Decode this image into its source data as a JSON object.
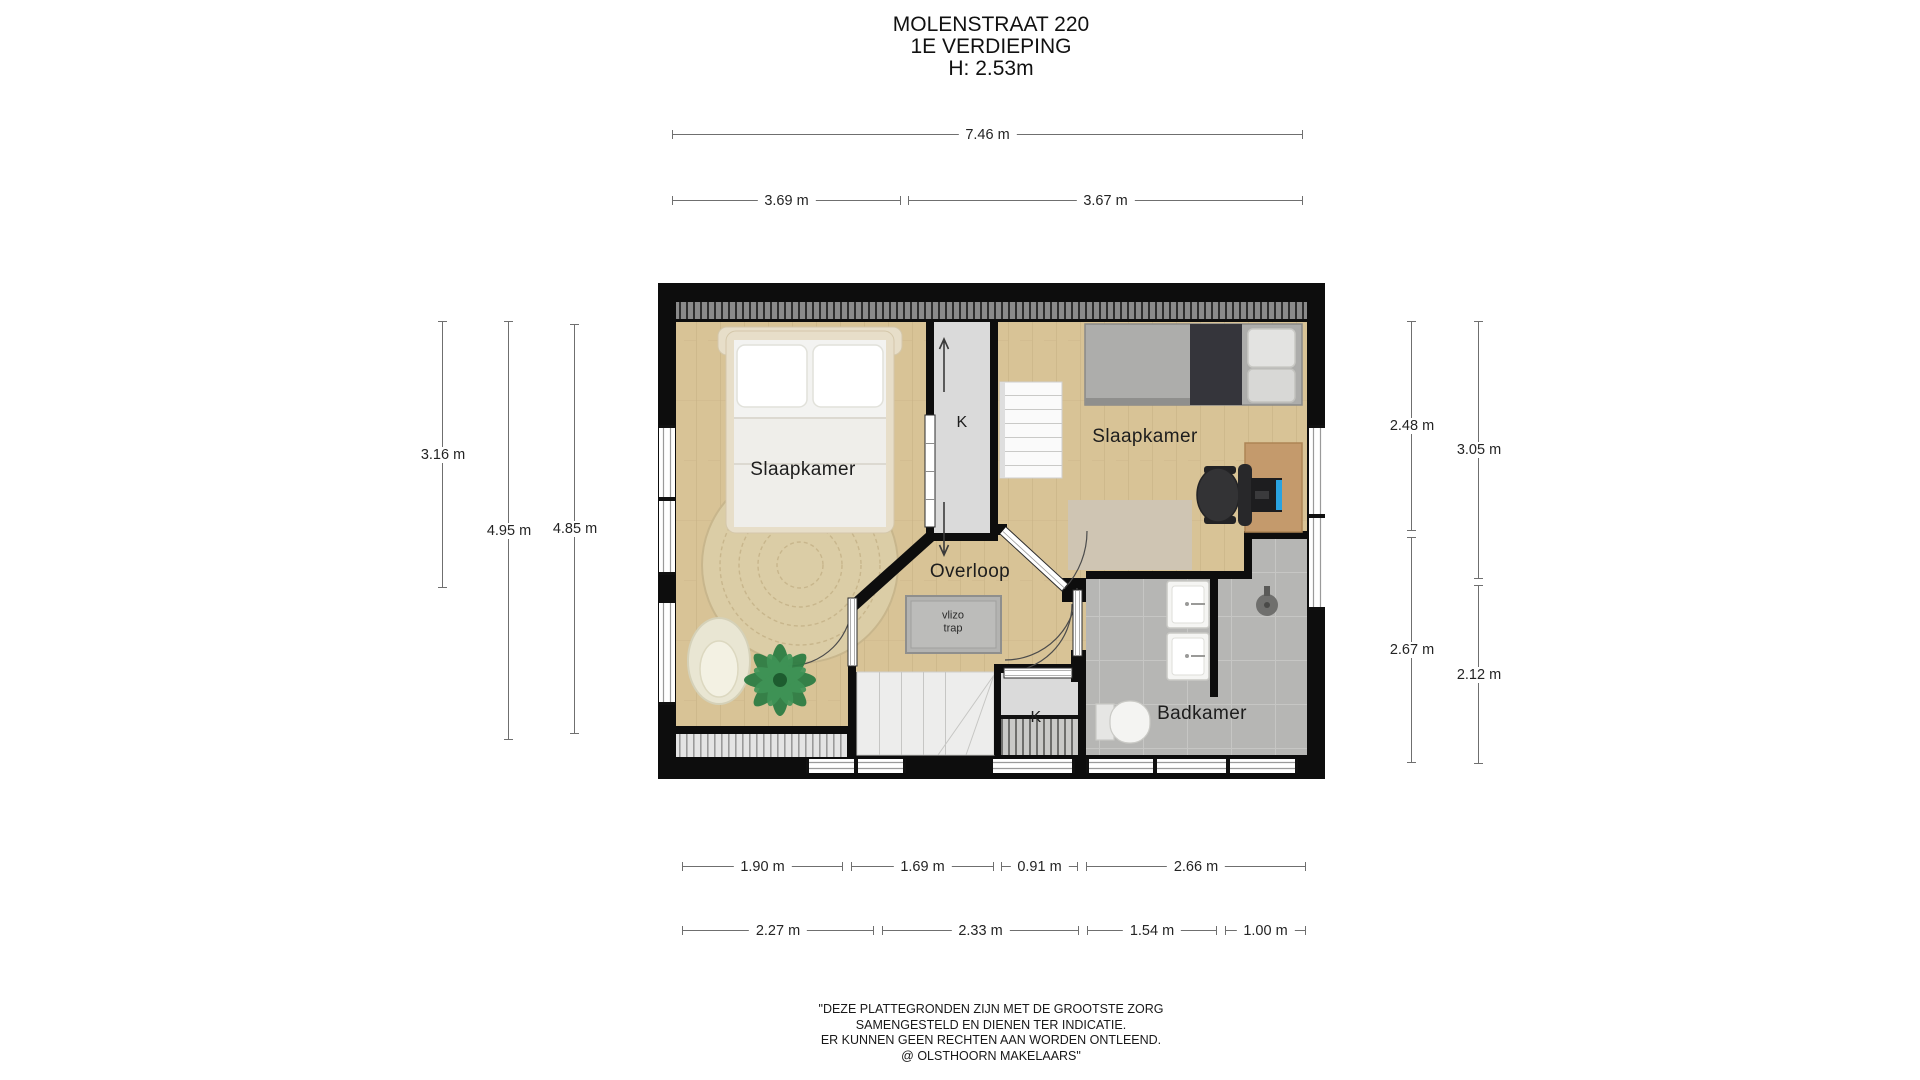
{
  "title": {
    "address": "MOLENSTRAAT 220",
    "floor": "1E VERDIEPING",
    "ceiling_height": "H: 2.53m"
  },
  "rooms": {
    "bedroom_left": "Slaapkamer",
    "bedroom_right": "Slaapkamer",
    "landing": "Overloop",
    "bathroom": "Badkamer",
    "closet_top": "K",
    "closet_bottom": "K",
    "loft_hatch_line1": "vlizo",
    "loft_hatch_line2": "trap"
  },
  "dimensions": {
    "total_width": "7.46 m",
    "width_left": "3.69 m",
    "width_right": "3.67 m",
    "left_inner": "3.16 m",
    "left_mid": "4.95 m",
    "left_outer": "4.85 m",
    "right_top_inner": "2.48 m",
    "right_bottom_inner": "2.67 m",
    "right_top_outer": "3.05 m",
    "right_bottom_outer": "2.12 m",
    "bottom_row1": [
      "1.90 m",
      "1.69 m",
      "0.91 m",
      "2.66 m"
    ],
    "bottom_row2": [
      "2.27 m",
      "2.33 m",
      "1.54 m",
      "1.00 m"
    ]
  },
  "disclaimer": {
    "line1": "\"DEZE PLATTEGRONDEN ZIJN MET DE GROOTSTE ZORG",
    "line2": "SAMENGESTELD EN DIENEN TER INDICATIE.",
    "line3": "ER KUNNEN GEEN RECHTEN AAN WORDEN ONTLEEND.",
    "line4": "@ OLSTHOORN MAKELAARS\""
  },
  "colors": {
    "wall": "#0d0d0d",
    "wood_floor": "#d8c396",
    "tile_floor": "#b6b6b4",
    "closet_floor": "#dadada",
    "dimension_line": "#6f6f6f"
  }
}
